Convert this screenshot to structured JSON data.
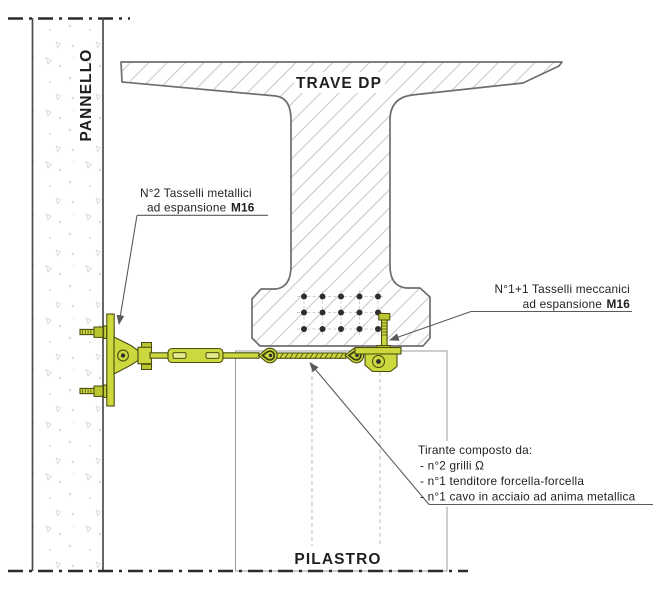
{
  "drawing": {
    "labels": {
      "panel": "PANNELLO",
      "beam": "TRAVE DP",
      "pillar": "PILASTRO",
      "anchor_left_line1": "N°2 Tasselli metallici",
      "anchor_left_line2_regular": "ad espansione ",
      "anchor_left_line2_bold": "M16",
      "anchor_right_line1": "N°1+1 Tasselli meccanici",
      "anchor_right_line2_regular": "ad espansione ",
      "anchor_right_line2_bold": "M16",
      "tie_title": "Tirante composto da:",
      "tie_item1": "- n°2 grilli Ω",
      "tie_item2": "- n°1 tenditore forcella-forcella",
      "tie_item3": "- n°1 cavo in acciaio ad anima metallica"
    },
    "colors": {
      "hardware_fill": "#ccd83e",
      "hardware_dark": "#b9c42f",
      "hardware_outline": "#4b4d0e",
      "beam_outline": "#6e6e6e",
      "hatch": "#c9c9c9",
      "centerline": "#2b2b2b",
      "leader": "#5a5a5a",
      "text": "#1f1f1f"
    }
  }
}
